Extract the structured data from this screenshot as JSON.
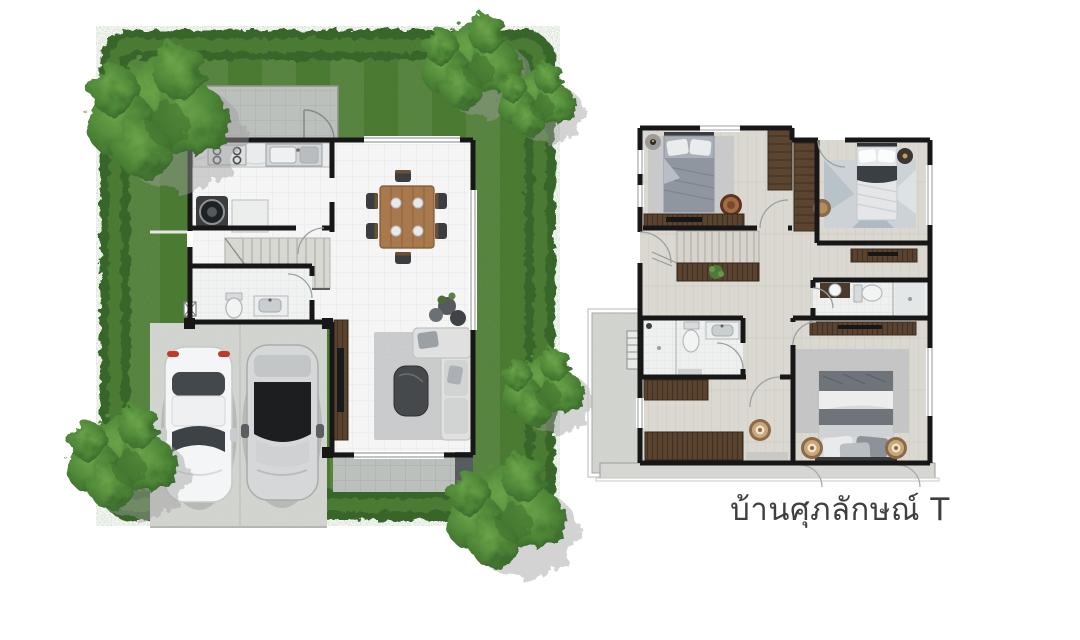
{
  "page": {
    "width_px": 1080,
    "height_px": 640,
    "background": "#ffffff"
  },
  "caption": {
    "text": "บ้านศุภลักษณ์ T"
  },
  "palette": {
    "caption_color": "#3f3f41",
    "hedge_green": "#39652a",
    "hedge_light": "#4e7d34",
    "lawn_green": "#4d7d33",
    "tree_green": "#4d8536",
    "shadow_gray": "#9e9e9e",
    "wall_black": "#171717",
    "floor_white": "#f4f5f4",
    "terrace_gray": "#bcc0bc",
    "concrete_gray": "#d3d5d1",
    "plank_floor": "#dbd8d2",
    "wood_dark": "#5a4430",
    "wood_table": "#a8794d",
    "rug_gray": "#cccdce",
    "sofa_gray": "#dfe0df",
    "car_white": "#f4f5f6",
    "car_silver": "#d5d7d8",
    "glass_dark": "#1c1e20",
    "taillight_red": "#c0392b"
  },
  "plans": {
    "ground_floor": {
      "name": "ground-floor-plan",
      "objects": [
        "garden-hedge",
        "lawn",
        "trees",
        "covered-terrace",
        "kitchen-counter",
        "stove",
        "kitchen-sink",
        "washing-machine",
        "kitchen-table",
        "staircase",
        "toilet",
        "vanity-sink",
        "dining-table",
        "dining-chairs",
        "tv-console",
        "sofa",
        "coffee-table",
        "rug",
        "decor-rocks",
        "rear-terrace",
        "garage-slab",
        "car-white",
        "car-silver"
      ]
    },
    "upper_floor": {
      "name": "upper-floor-plan",
      "objects": [
        "bedroom-1-bed",
        "bedroom-1-rug",
        "bedroom-1-dresser",
        "wardrobe-a",
        "wardrobe-b",
        "bedroom-2-bed",
        "bedroom-2-rug",
        "bedroom-2-dresser",
        "staircase",
        "console-with-plant",
        "bathroom-top",
        "bathroom-mid",
        "cabinet",
        "study-cabinet",
        "pouf",
        "master-bed",
        "master-rug",
        "master-dresser",
        "side-balcony",
        "rear-balcony"
      ]
    }
  }
}
